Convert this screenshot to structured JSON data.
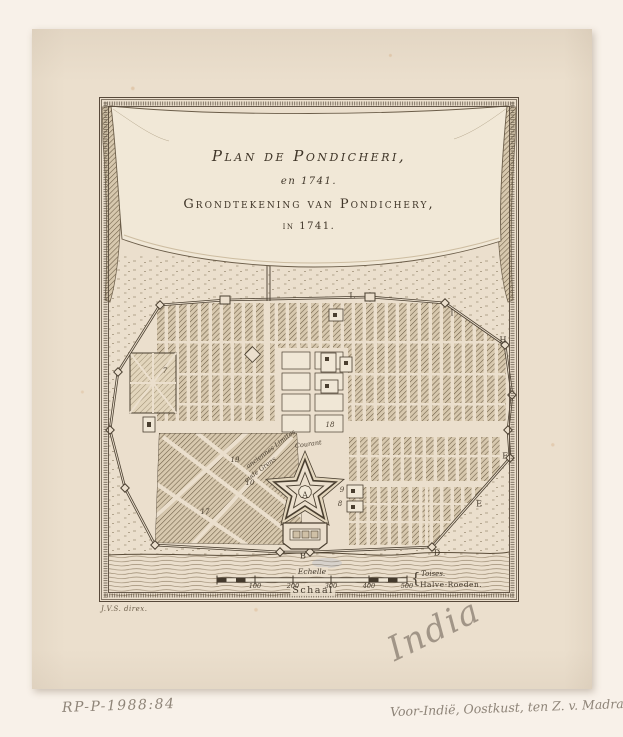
{
  "plate": {
    "title_line1": "Plan de Pondicheri,",
    "title_line2": "en 1741.",
    "title_line3": "Grondtekening van Pondichery,",
    "title_line4": "in 1741.",
    "signature": "J.V.S. direx."
  },
  "scale": {
    "echelle": "Echelle",
    "schaal": "Schaal",
    "t1": "100",
    "t2": "200",
    "t3": "300",
    "t4": "400",
    "t5": "500",
    "unit_brace": "{",
    "unit_top": "Toises.",
    "unit_bottom": "Halve-Roeden."
  },
  "map": {
    "letters": {
      "A": "A",
      "B": "B",
      "D": "D",
      "E": "E",
      "F": "F",
      "I": "I",
      "H": "H",
      "L": "L"
    },
    "numbers": {
      "n7": "7",
      "n8": "8",
      "n9": "9",
      "n10": "10",
      "n17": "17",
      "n18": "18",
      "n19": "19"
    },
    "labels": {
      "courant": "Courant",
      "anciennes": "anciennes Limites",
      "oude": "oude Grens"
    }
  },
  "annotations": {
    "accession": "RP-P-1988:84",
    "pencil_region": "Voor-Indië, Oostkust, ten Z. v. Madras",
    "pencil_title": "India"
  },
  "colors": {
    "paper": "#ebdfcd",
    "ink": "#43392c",
    "pencil": "#8e8478"
  }
}
